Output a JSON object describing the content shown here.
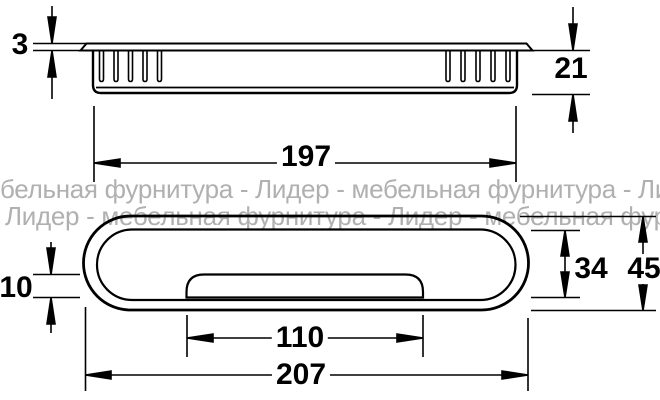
{
  "watermark": {
    "line1": "бельная фурнитура - Лидер - мебельная фурнитура - Лидер",
    "line2": "Лидер - мебельная фурнитура - Лидер - мебельная фурнит"
  },
  "dimensions": {
    "flange_thickness": "3",
    "recess_depth": "21",
    "body_length": "197",
    "lip_height": "10",
    "inner_height": "34",
    "outer_height": "45",
    "lid_length": "110",
    "overall_length": "207"
  },
  "colors": {
    "line": "#000000",
    "watermark": "#b0b0b0",
    "background": "#ffffff"
  }
}
